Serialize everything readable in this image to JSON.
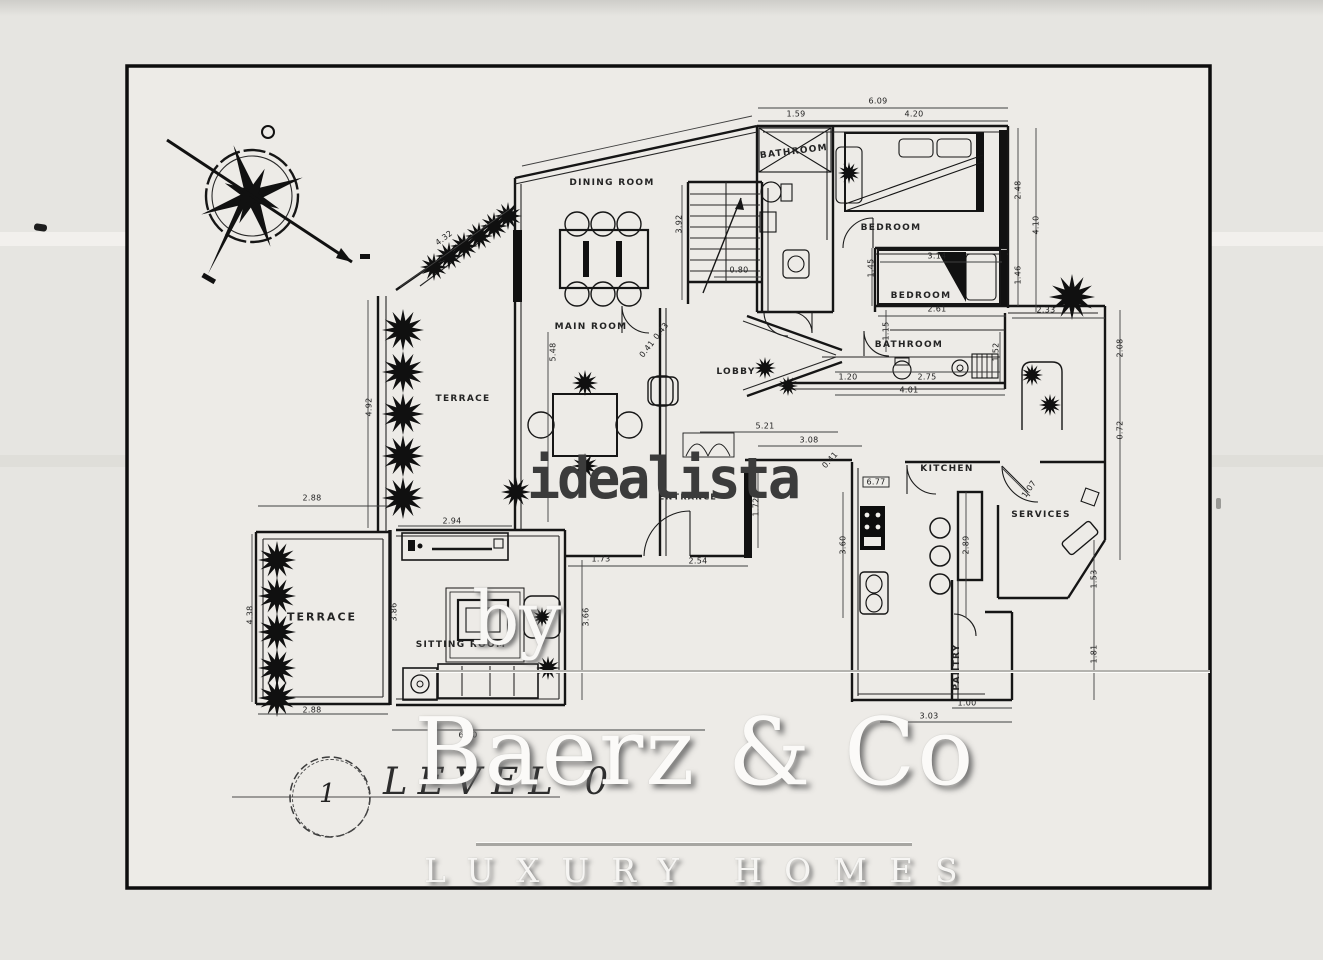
{
  "page": {
    "background": "#e6e5e1",
    "paper_color": "#edebe7",
    "frame_color": "#0d0d0d",
    "ink_color": "#1a1a1a",
    "watermark_gray": "#3b3b3b"
  },
  "icons": {
    "compass": "compass-rose",
    "tree": "bush-cluster",
    "stairs": "stair-flight"
  },
  "watermarks": {
    "idealista": "idealista",
    "by": "by",
    "brand": "Baerz & Co",
    "tagline": "LUXURY HOMES"
  },
  "plan": {
    "level_label": "LEVEL 0",
    "sheet_number": "1",
    "rooms": [
      "DINING ROOM",
      "MAIN ROOM",
      "TERRACE",
      "LOBBY",
      "BATHROOM",
      "BEDROOM",
      "BEDROOM",
      "BATHROOM",
      "KITCHEN",
      "SERVICES",
      "PANTRY",
      "SITTING ROOM",
      "TERRACE",
      "ENTRANCE"
    ],
    "dims": [
      "6.09",
      "1.59",
      "4.20",
      "2.48",
      "4.10",
      "1.46",
      "3.14",
      "2.61",
      "1.15",
      "1.45",
      "2.33",
      "2.08",
      "0.72",
      "3.92",
      "0.80",
      "0.43",
      "0.41",
      "1.20",
      "2.75",
      "4.01",
      "1.52",
      "5.21",
      "3.08",
      "0.41",
      "1.72",
      "6.77",
      "3.60",
      "2.89",
      "1.07",
      "1.53",
      "1.81",
      "1.00",
      "3.03",
      "2.88",
      "2.94",
      "2.88",
      "6.40",
      "1.73",
      "2.54",
      "3.66",
      "3.86",
      "4.38",
      "4.92",
      "5.48",
      "4.32"
    ]
  }
}
